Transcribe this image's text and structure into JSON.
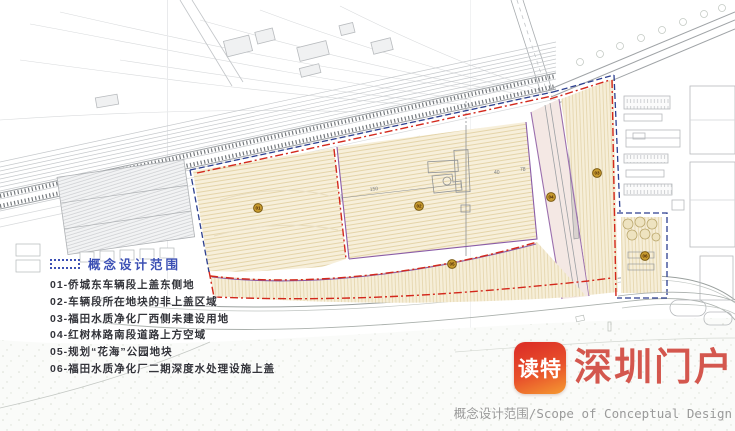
{
  "legend": {
    "title": "概念设计范围",
    "items": [
      {
        "label": "01-侨城东车辆段上盖东侧地"
      },
      {
        "label": "02-车辆段所在地块的非上盖区域"
      },
      {
        "label": "03-福田水质净化厂西侧未建设用地"
      },
      {
        "label": "04-红树林路南段道路上方空域"
      },
      {
        "label": "05-规划“花海”公园地块"
      },
      {
        "label": "06-福田水质净化厂二期深度水处理设施上盖"
      }
    ]
  },
  "map": {
    "markers": [
      {
        "num": "01"
      },
      {
        "num": "02"
      },
      {
        "num": "03"
      },
      {
        "num": "04"
      },
      {
        "num": "05"
      },
      {
        "num": "06"
      }
    ],
    "dimensions": [
      {
        "text": "150"
      },
      {
        "text": "40"
      },
      {
        "text": "78"
      }
    ],
    "colors": {
      "boundary_red": "#d3281c",
      "boundary_blue": "#2c3f8f",
      "area_fill": "#f7efda",
      "purple_edge": "#9b6fae",
      "marker_fill": "#c89b2f"
    }
  },
  "watermark": {
    "app_name": "读特",
    "site_name": "深圳门户"
  },
  "caption": "概念设计范围/Scope of Conceptual Design"
}
